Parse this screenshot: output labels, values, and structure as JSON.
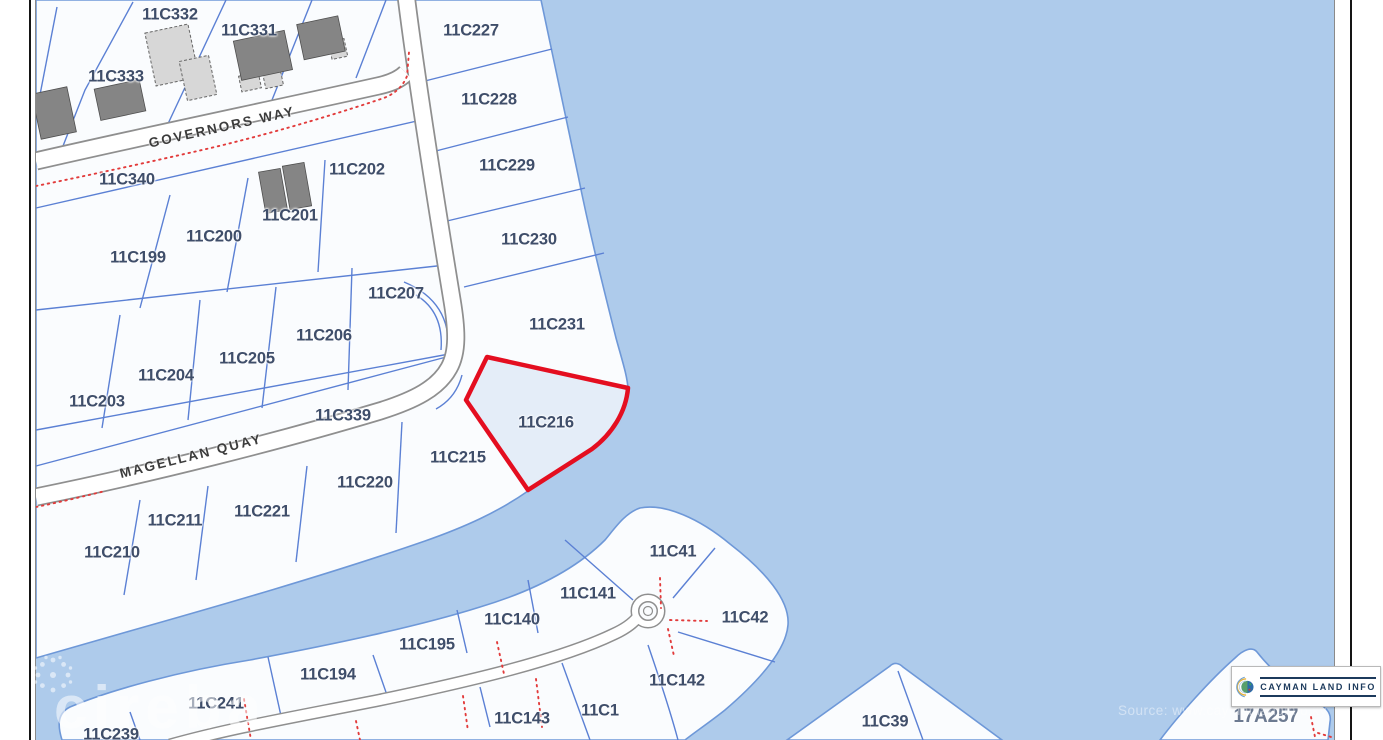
{
  "map": {
    "selected_parcel": "11C216",
    "parcels": [
      {
        "id": "11C332",
        "x": 170,
        "y": 15
      },
      {
        "id": "11C331",
        "x": 249,
        "y": 31
      },
      {
        "id": "11C333",
        "x": 116,
        "y": 77
      },
      {
        "id": "11C227",
        "x": 471,
        "y": 31
      },
      {
        "id": "11C228",
        "x": 489,
        "y": 100
      },
      {
        "id": "11C229",
        "x": 507,
        "y": 166
      },
      {
        "id": "11C230",
        "x": 529,
        "y": 240
      },
      {
        "id": "11C231",
        "x": 557,
        "y": 325
      },
      {
        "id": "11C340",
        "x": 127,
        "y": 180
      },
      {
        "id": "11C202",
        "x": 357,
        "y": 170
      },
      {
        "id": "11C201",
        "x": 290,
        "y": 216
      },
      {
        "id": "11C200",
        "x": 214,
        "y": 237
      },
      {
        "id": "11C199",
        "x": 138,
        "y": 258
      },
      {
        "id": "11C207",
        "x": 396,
        "y": 294
      },
      {
        "id": "11C206",
        "x": 324,
        "y": 336
      },
      {
        "id": "11C205",
        "x": 247,
        "y": 359
      },
      {
        "id": "11C204",
        "x": 166,
        "y": 376
      },
      {
        "id": "11C203",
        "x": 97,
        "y": 402
      },
      {
        "id": "11C339",
        "x": 343,
        "y": 416
      },
      {
        "id": "11C216",
        "x": 546,
        "y": 423
      },
      {
        "id": "11C215",
        "x": 458,
        "y": 458
      },
      {
        "id": "11C220",
        "x": 365,
        "y": 483
      },
      {
        "id": "11C221",
        "x": 262,
        "y": 512
      },
      {
        "id": "11C211",
        "x": 175,
        "y": 521
      },
      {
        "id": "11C210",
        "x": 112,
        "y": 553
      },
      {
        "id": "11C41",
        "x": 673,
        "y": 552
      },
      {
        "id": "11C141",
        "x": 588,
        "y": 594
      },
      {
        "id": "11C42",
        "x": 745,
        "y": 618
      },
      {
        "id": "11C140",
        "x": 512,
        "y": 620
      },
      {
        "id": "11C195",
        "x": 427,
        "y": 645
      },
      {
        "id": "11C194",
        "x": 328,
        "y": 675
      },
      {
        "id": "11C142",
        "x": 677,
        "y": 681
      },
      {
        "id": "11C241",
        "x": 216,
        "y": 704
      },
      {
        "id": "11C1",
        "x": 600,
        "y": 711
      },
      {
        "id": "11C143",
        "x": 522,
        "y": 719
      },
      {
        "id": "11C239",
        "x": 111,
        "y": 735
      },
      {
        "id": "11C39",
        "x": 885,
        "y": 722
      },
      {
        "id": "17A257",
        "x": 1266,
        "y": 717,
        "f": true
      }
    ],
    "streets": [
      {
        "name": "GOVERNORS WAY",
        "x": 222,
        "y": 127,
        "angle": -12.5
      },
      {
        "name": "MAGELLAN QUAY",
        "x": 191,
        "y": 456,
        "angle": -14
      }
    ],
    "logo": {
      "text": "CAYMAN LAND INFO"
    },
    "watermarks": {
      "brand": "cireba",
      "source": "Source: www.caymanlandinfo.ky"
    },
    "colors": {
      "water": "#aecbeb",
      "land": "#fafcfe",
      "shore": "#6e98d8",
      "parcel_line": "#5b80d4",
      "road_edge": "#8f8f8f",
      "road_fill": "#ffffff",
      "red_dotted": "#e23b3b",
      "selected_outline": "#e40e20",
      "selected_fill": "#e4edf8",
      "label": "#3f4e6a",
      "street": "#3c3c3c",
      "building_dark": "#858585",
      "building_light": "#d7d7d7",
      "logo_navy": "#1c3a5c"
    }
  }
}
